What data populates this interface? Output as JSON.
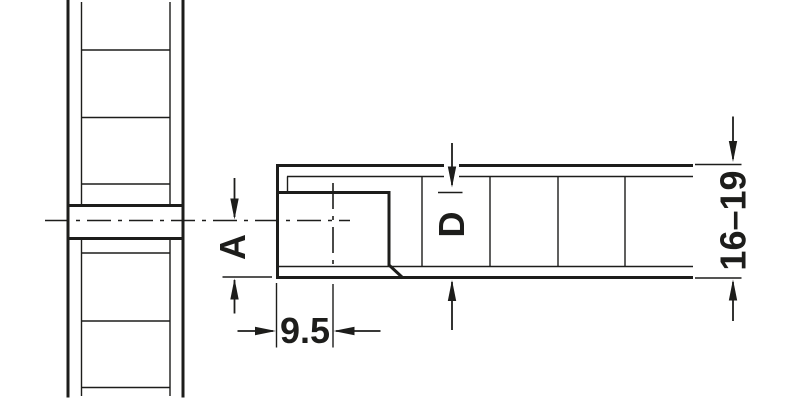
{
  "drawing": {
    "background": "#ffffff",
    "line_color": "#1d1d1b",
    "labels": {
      "axis_to_surface": "A",
      "drill_depth": "D",
      "edge_distance": "9.5",
      "panel_thickness": "16–19"
    }
  }
}
